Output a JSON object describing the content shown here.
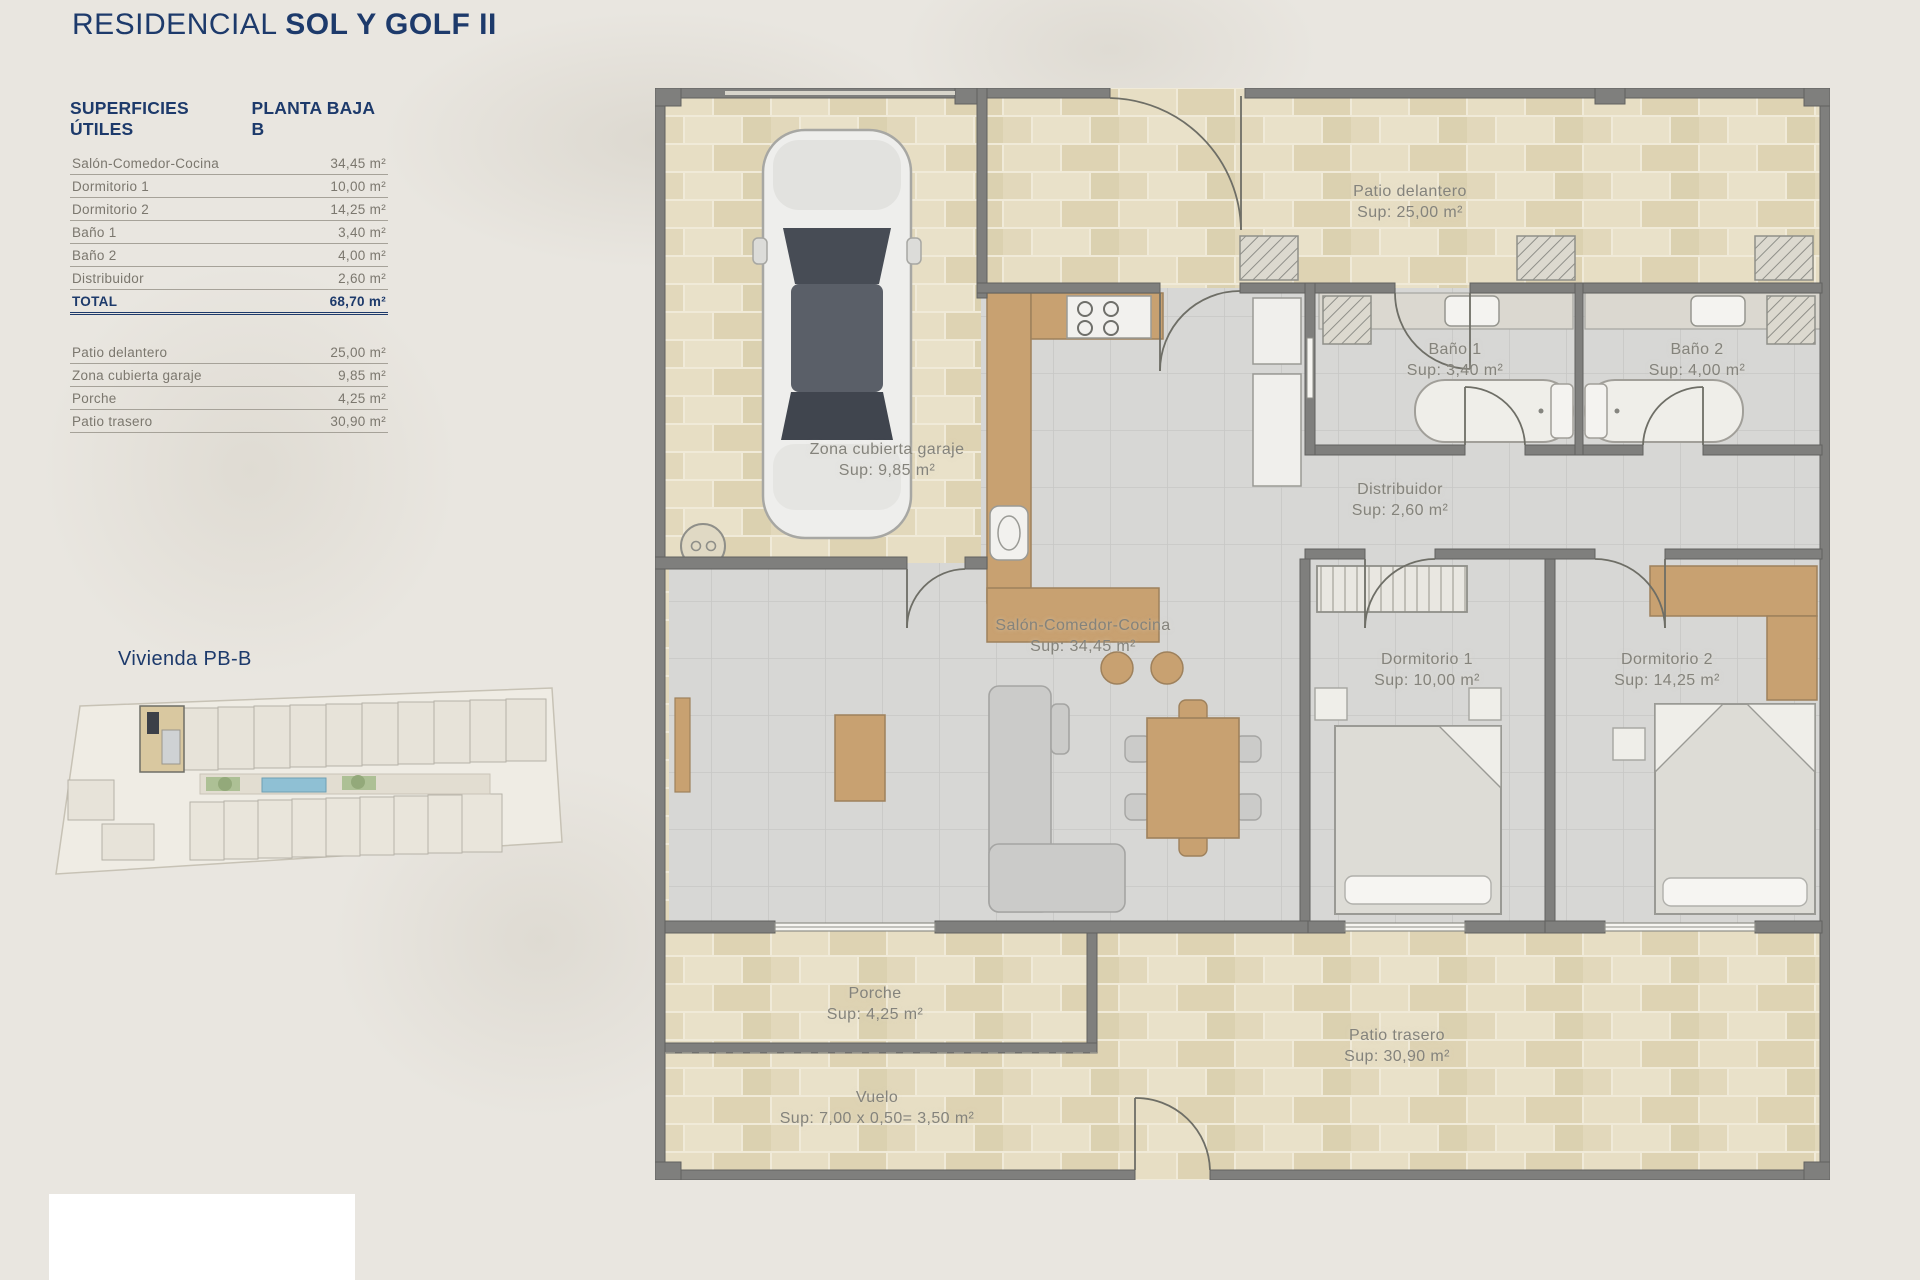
{
  "page": {
    "title_prefix": "RESIDENCIAL",
    "title_main": "SOL Y GOLF II"
  },
  "surface_table": {
    "header_left": "SUPERFICIES ÚTILES",
    "header_right": "PLANTA BAJA B",
    "interior_rows": [
      {
        "label": "Salón-Comedor-Cocina",
        "value": "34,45 m²"
      },
      {
        "label": "Dormitorio 1",
        "value": "10,00 m²"
      },
      {
        "label": "Dormitorio 2",
        "value": "14,25 m²"
      },
      {
        "label": "Baño 1",
        "value": "3,40 m²"
      },
      {
        "label": "Baño 2",
        "value": "4,00 m²"
      },
      {
        "label": "Distribuidor",
        "value": "2,60 m²"
      }
    ],
    "total": {
      "label": "TOTAL",
      "value": "68,70 m²"
    },
    "exterior_rows": [
      {
        "label": "Patio delantero",
        "value": "25,00 m²"
      },
      {
        "label": "Zona cubierta garaje",
        "value": "9,85 m²"
      },
      {
        "label": "Porche",
        "value": "4,25 m²"
      },
      {
        "label": "Patio trasero",
        "value": "30,90 m²"
      }
    ]
  },
  "site_plan": {
    "label": "Vivienda PB-B"
  },
  "floor_plan": {
    "rooms": [
      {
        "name": "Patio delantero",
        "sup": "Sup: 25,00 m²"
      },
      {
        "name": "Zona cubierta garaje",
        "sup": "Sup: 9,85 m²"
      },
      {
        "name": "Baño 1",
        "sup": "Sup: 3,40 m²"
      },
      {
        "name": "Baño 2",
        "sup": "Sup: 4,00 m²"
      },
      {
        "name": "Distribuidor",
        "sup": "Sup: 2,60 m²"
      },
      {
        "name": "Salón-Comedor-Cocina",
        "sup": "Sup: 34,45 m²"
      },
      {
        "name": "Dormitorio 1",
        "sup": "Sup: 10,00 m²"
      },
      {
        "name": "Dormitorio 2",
        "sup": "Sup: 14,25 m²"
      },
      {
        "name": "Porche",
        "sup": "Sup: 4,25 m²"
      },
      {
        "name": "Patio trasero",
        "sup": "Sup: 30,90 m²"
      },
      {
        "name": "Vuelo",
        "sup": "Sup: 7,00 x 0,50= 3,50 m²"
      }
    ]
  },
  "colors": {
    "navy": "#1d3a6b",
    "plan_label_gray": "#84837c",
    "beige_tile": "#e4dbbf",
    "gray_tile": "#d7d7d5",
    "wall_gray": "#7f7f7d",
    "wood": "#c8a171",
    "background": "#e9e6e0",
    "pool_blue": "#8fc0d4"
  }
}
